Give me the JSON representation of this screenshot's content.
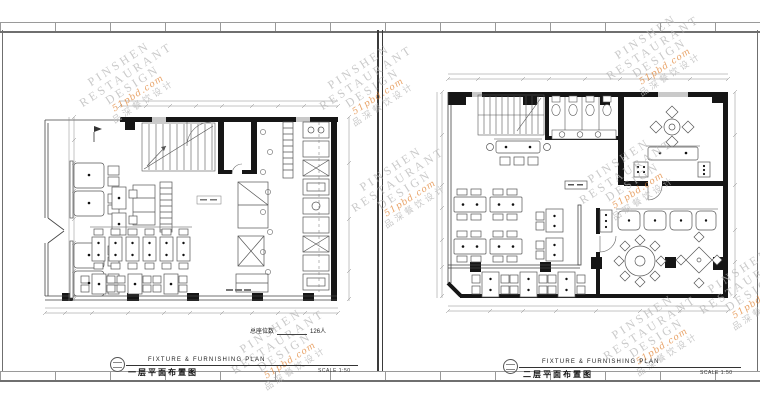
{
  "document": {
    "watermark": {
      "line1": "PINSHEN",
      "line2": "RESTAURANT",
      "line3": "DESIGN",
      "script": "51pbd.com",
      "cn": "品深餐饮设计",
      "gray": "#b5b5b5",
      "orange": "#e0802f"
    },
    "sheets": {
      "left": {
        "title_en": "FIXTURE & FURNISHING PLAN",
        "title_cn": "一层平面布置图",
        "scale": "SCALE 1:50",
        "seat_note_label": "总座位数",
        "seat_note_value": "126人"
      },
      "right": {
        "title_en": "FIXTURE & FURNISHING PLAN",
        "title_cn": "二层平面布置图",
        "scale": "SCALE 1:50"
      }
    }
  }
}
